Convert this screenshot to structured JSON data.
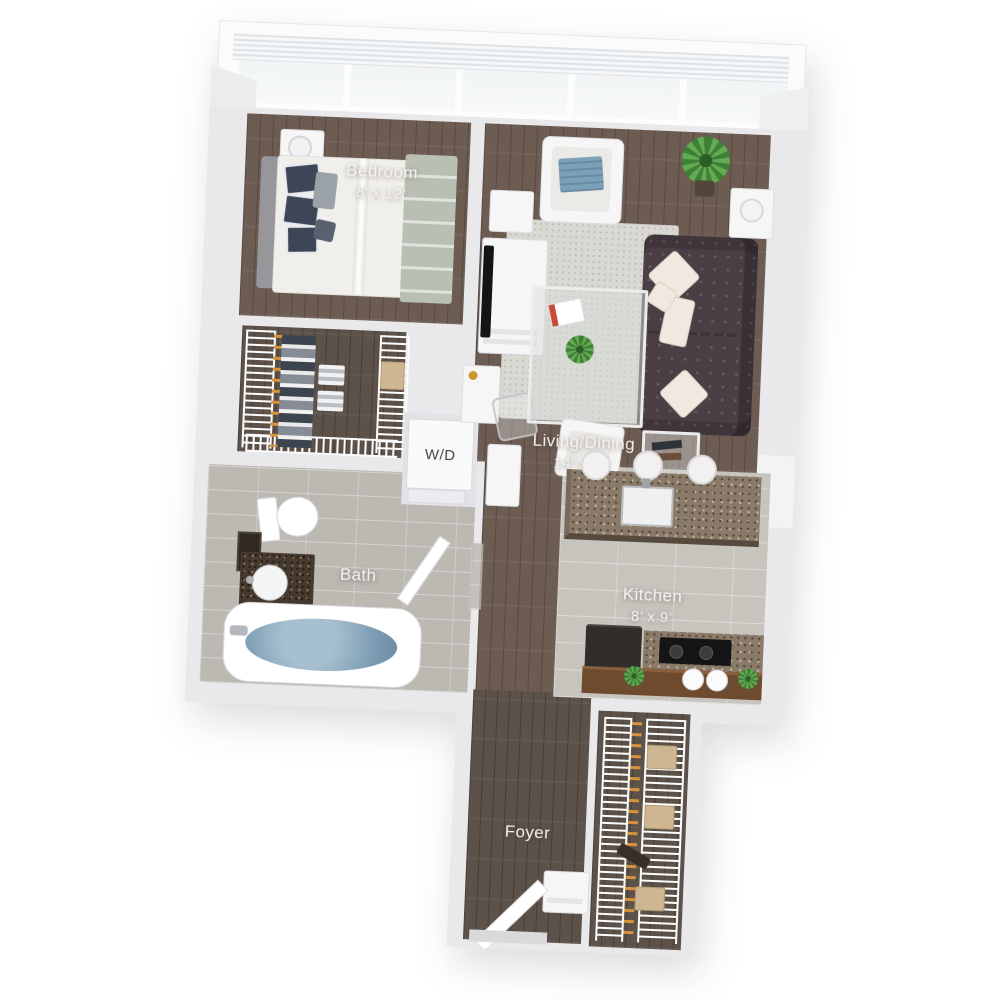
{
  "plan": {
    "type": "3d-apartment-floor-plan",
    "style": "top-down rendered 3D floor plan, one-bedroom apartment, white background"
  },
  "rooms": {
    "bedroom": {
      "label": "Bedroom",
      "dims": "8’ x 12’"
    },
    "living": {
      "label": "Living/Dining",
      "dims": "14’ x 18’"
    },
    "kitchen": {
      "label": "Kitchen",
      "dims": "8’ x 9’"
    },
    "bath": {
      "label": "Bath"
    },
    "laundry": {
      "label": "W/D"
    },
    "foyer": {
      "label": "Foyer"
    }
  },
  "colors": {
    "background": "#ffffff",
    "wall": "#e9e9ec",
    "wood_floor": "#6d5c52",
    "foyer_wood": "#5c524a",
    "kitchen_tile": "#c7c3bd",
    "bath_tile": "#bcb8b2",
    "rug": "#dad8d2",
    "sofa": "#4b3e45",
    "granite_counter": "#8a7a69",
    "vanity_granite": "#46392d",
    "tub_water": "#7d9cb3",
    "plant_green": "#4e9342",
    "hanger_orange": "#d8923c",
    "bar_wood": "#6e4a2f",
    "label_text": "#f4f2ef",
    "wd_text": "#41464b"
  },
  "furniture": [
    "window-wall-blinds",
    "bed",
    "nightstand-lamp",
    "walk-in-closet-shelving",
    "washer-dryer",
    "toilet",
    "vanity-sink",
    "mirror",
    "bathtub",
    "sofa",
    "armchair",
    "area-rug",
    "coffee-table",
    "accent-chair",
    "end-table",
    "side-table",
    "floor-plant",
    "tv-console",
    "tv",
    "desk",
    "desk-chair",
    "pantry-cabinet",
    "kitchen-island-sink",
    "bar-stools",
    "refrigerator",
    "cooktop",
    "bar-counter-canisters-plants",
    "entry-bench",
    "entry-door",
    "coat-closet-shelving"
  ]
}
